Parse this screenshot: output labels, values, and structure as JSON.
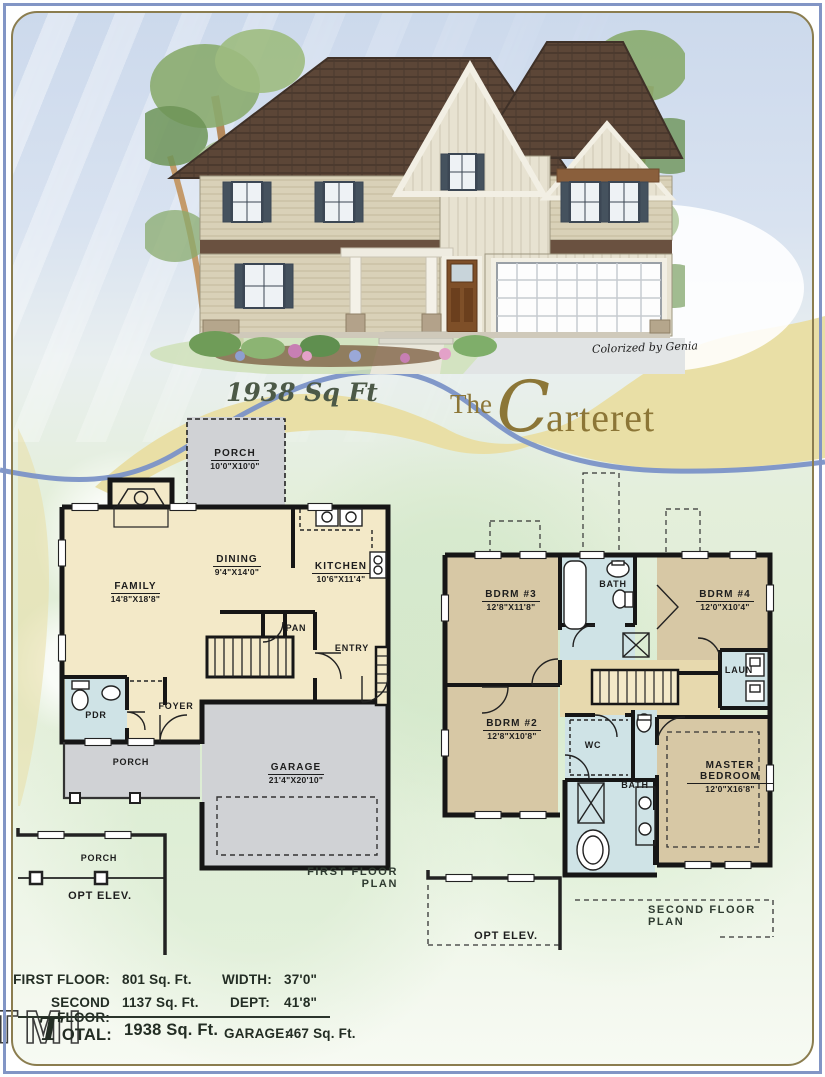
{
  "page": {
    "credit": "Colorized by Genia",
    "sqft": "1938 Sq Ft",
    "title_prefix": "The",
    "title_name": "Carteret"
  },
  "first_floor": {
    "caption": "FIRST  FLOOR PLAN",
    "rooms": {
      "porch_top": {
        "name": "PORCH",
        "dim": "10'0\"X10'0\""
      },
      "family": {
        "name": "FAMILY",
        "dim": "14'8\"X18'8\""
      },
      "dining": {
        "name": "DINING",
        "dim": "9'4\"X14'0\""
      },
      "kitchen": {
        "name": "KITCHEN",
        "dim": "10'6\"X11'4\""
      },
      "pan": "PAN",
      "entry": "ENTRY",
      "foyer": "FOYER",
      "pdr": "PDR",
      "porch_front": "PORCH",
      "garage": {
        "name": "GARAGE",
        "dim": "21'4\"X20'10\""
      }
    },
    "opt_elev": {
      "porch": "PORCH",
      "label": "OPT  ELEV."
    }
  },
  "second_floor": {
    "caption": "SECOND  FLOOR PLAN",
    "rooms": {
      "bdrm3": {
        "name": "BDRM #3",
        "dim": "12'8\"X11'8\""
      },
      "bath_top": "BATH",
      "bdrm4": {
        "name": "BDRM #4",
        "dim": "12'0\"X10'4\""
      },
      "laun": "LAUN",
      "bdrm2": {
        "name": "BDRM #2",
        "dim": "12'8\"X10'8\""
      },
      "wc": "WC",
      "bath_main": "BATH",
      "master": {
        "name": "MASTER BEDROOM",
        "dim": "12'0\"X16'8\""
      }
    },
    "opt_elev": {
      "label": "OPT  ELEV."
    }
  },
  "stats": {
    "left": [
      {
        "label": "FIRST FLOOR:",
        "value": "801 Sq. Ft."
      },
      {
        "label": "SECOND FLOOR:",
        "value": "1137 Sq. Ft."
      },
      {
        "label": "TOTAL:",
        "value": "1938 Sq. Ft."
      }
    ],
    "right": [
      {
        "label": "WIDTH:",
        "value": "37'0\""
      },
      {
        "label": "DEPT:",
        "value": "41'8\""
      },
      {
        "label": "GARAGE:",
        "value": "467 Sq. Ft."
      }
    ],
    "logo": "TMI"
  },
  "colors": {
    "ribbon_tan": "#e9dfa6",
    "ribbon_blue": "#7b92c7",
    "frame_blue": "#8295c5",
    "frame_gold": "#8b7d4f",
    "room_cream": "#f3e9c8",
    "room_gray": "#d0d2d5",
    "room_bath_blue": "#cfe3e6",
    "room_bedroom_tan": "#d7c8a5",
    "room_hall_khaki": "#e7d9ae",
    "title_olive": "#8c7637"
  }
}
